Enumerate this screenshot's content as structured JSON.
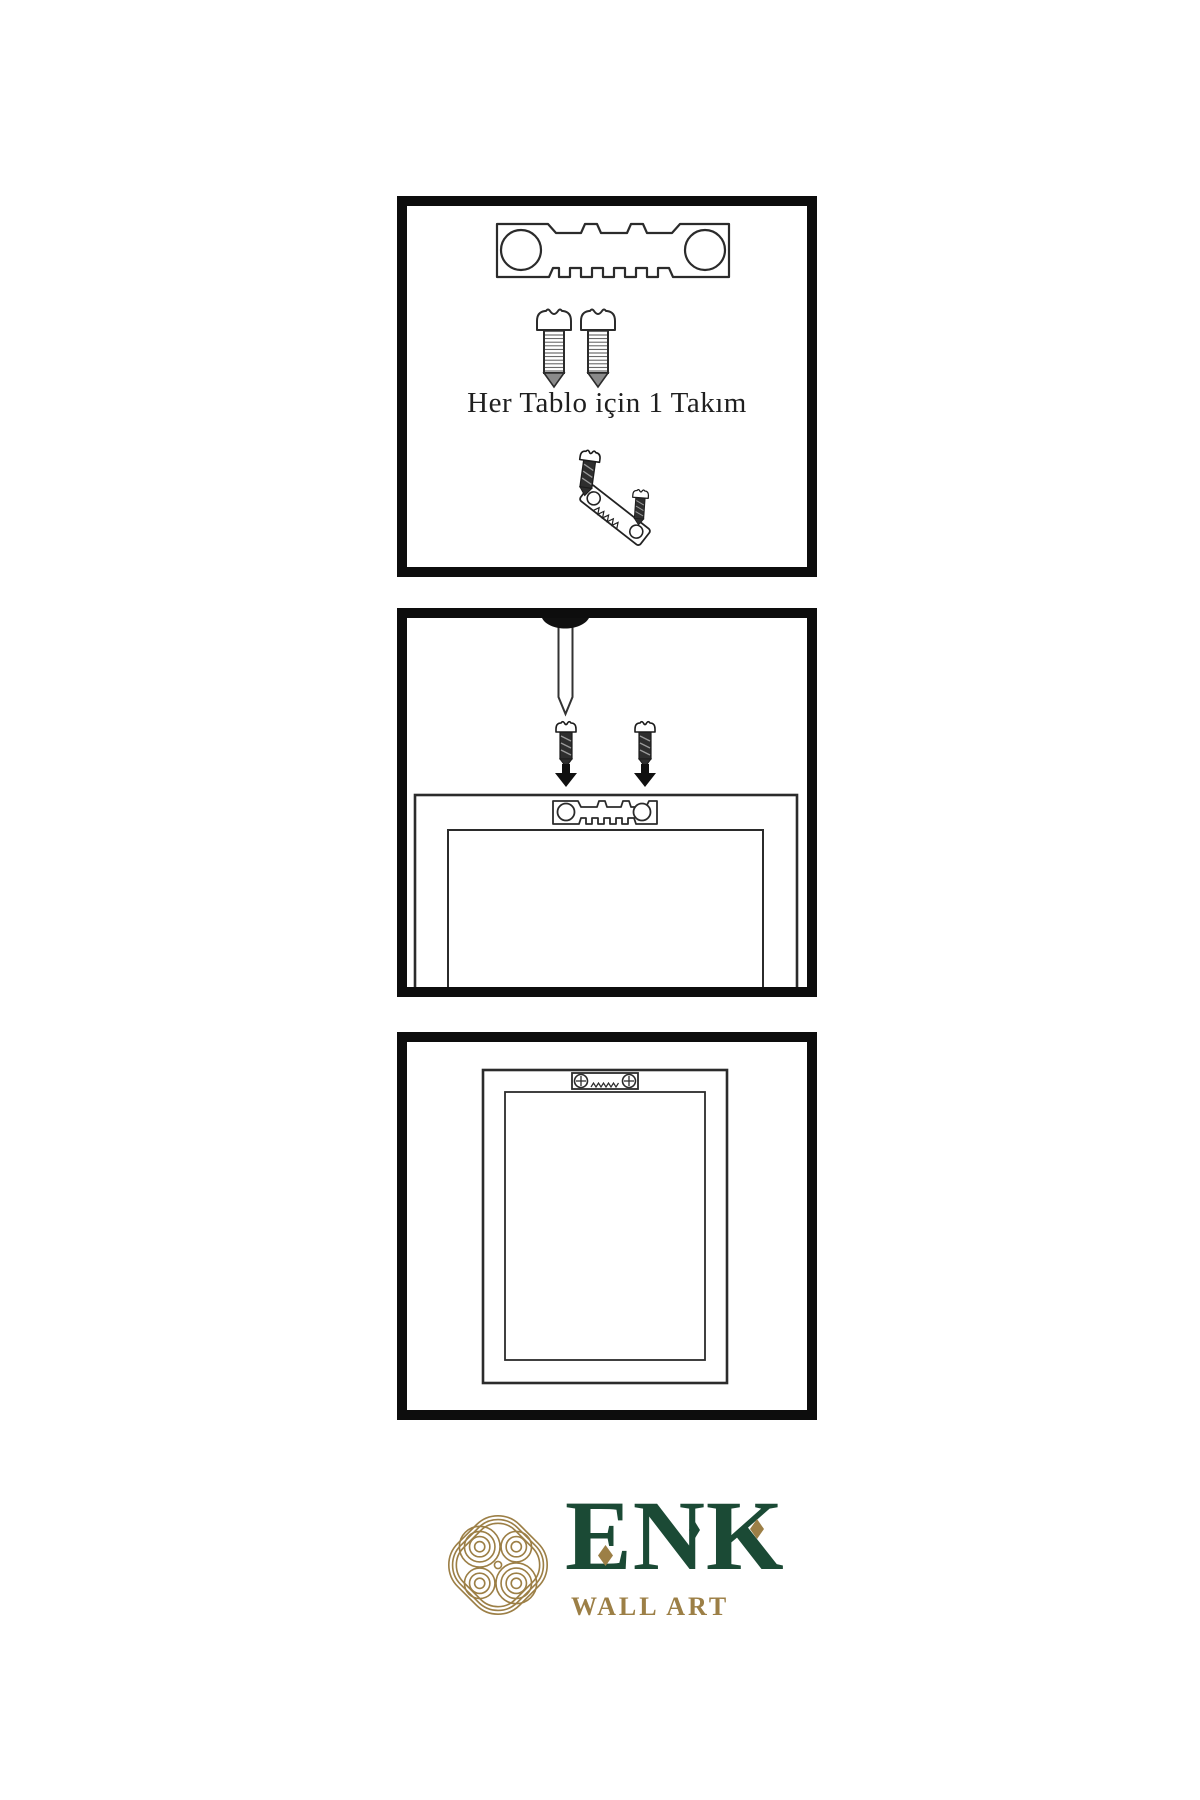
{
  "sheet": {
    "background": "#ffffff",
    "ink": "#2b2b2b",
    "panel_border": "#0d0d0d",
    "caption": "Her Tablo için 1 Takım"
  },
  "panels": [
    {
      "name": "hardware-kit",
      "caption": "Her Tablo için 1 Takım"
    },
    {
      "name": "wall-mounting",
      "caption": ""
    },
    {
      "name": "hung-frame",
      "caption": ""
    }
  ],
  "logo": {
    "wordmark": "ENK",
    "tagline": "WALL ART",
    "green": "#1b4a35",
    "gold": "#9c7f46"
  }
}
